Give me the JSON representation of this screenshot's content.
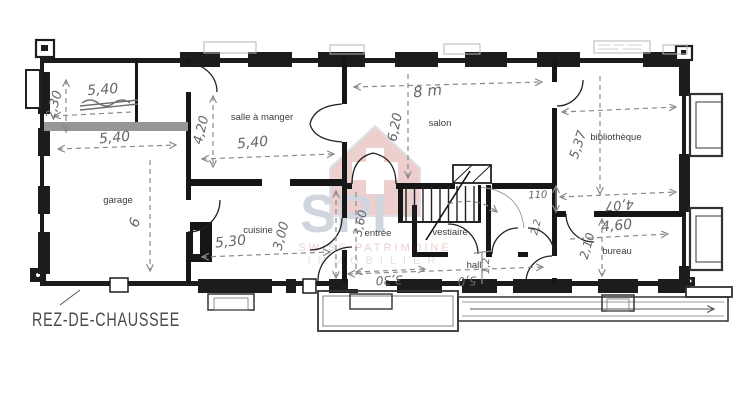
{
  "title": {
    "text": "REZ-DE-CHAUSSEE"
  },
  "rooms": [
    {
      "name": "garage"
    },
    {
      "name": "salle à manger"
    },
    {
      "name": "salon"
    },
    {
      "name": "bibliothèque"
    },
    {
      "name": "cuisine"
    },
    {
      "name": "entrée"
    },
    {
      "name": "vestiaire"
    },
    {
      "name": "hall"
    },
    {
      "name": "bureau"
    }
  ],
  "dimensions": [
    {
      "text": "2,30"
    },
    {
      "text": "5,40"
    },
    {
      "text": "5,40"
    },
    {
      "text": "6"
    },
    {
      "text": "4,20"
    },
    {
      "text": "5,40"
    },
    {
      "text": "8 m"
    },
    {
      "text": "6,20"
    },
    {
      "text": "5,37"
    },
    {
      "text": "4,07"
    },
    {
      "text": "110"
    },
    {
      "text": "2,2"
    },
    {
      "text": "4,60"
    },
    {
      "text": "2,10"
    },
    {
      "text": "5,30"
    },
    {
      "text": "3,00"
    },
    {
      "text": "3,60"
    },
    {
      "text": "3,30"
    },
    {
      "text": "5,0"
    },
    {
      "text": "1,2"
    }
  ],
  "watermark": {
    "monogram": "SPI",
    "line1": "SWISS PATRIMOINE",
    "line2": "IMMOBILIER"
  },
  "colors": {
    "wall": "#1c1c1c",
    "pencil_line": "#8a8a8a",
    "pencil_text": "#63666a",
    "label": "#3c3c3c",
    "watermark_red": "#c4625c",
    "watermark_blue": "#6b7a94",
    "watermark_gray": "#9a9a9a",
    "paper": "#ffffff"
  }
}
